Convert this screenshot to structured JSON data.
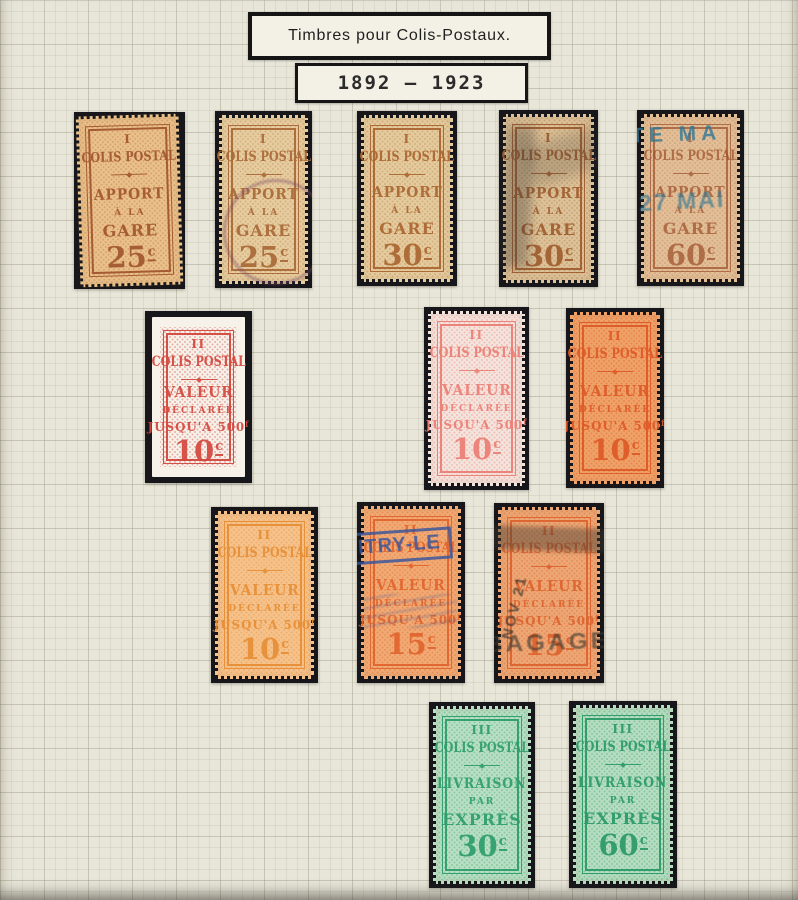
{
  "header": {
    "title": "Timbres pour Colis-Postaux.",
    "period": "1892 – 1923"
  },
  "palette": {
    "page_background": "#e8e6d9",
    "mount": "#17171b"
  },
  "stamps": [
    {
      "label": "apport-a-la-gare-25c-mint",
      "numeral": "I",
      "title": "COLIS POSTAL",
      "line1": "APPORT",
      "line2": "À LA",
      "line3": "GARE",
      "line3_sup": "",
      "value": "25",
      "unit": "c",
      "paper": "#eac18a",
      "ink": "#a2562f",
      "pattern": "rgba(162,86,47,0.30)"
    },
    {
      "label": "apport-a-la-gare-25c-used",
      "numeral": "I",
      "title": "COLIS POSTAL",
      "line1": "APPORT",
      "line2": "À LA",
      "line3": "GARE",
      "line3_sup": "",
      "value": "25",
      "unit": "c",
      "paper": "#e6cd9f",
      "ink": "#aa6a38",
      "pattern": "rgba(170,106,56,0.30)",
      "cancel": {
        "type": "circular-postmark",
        "color": "#7c4a68"
      }
    },
    {
      "label": "apport-a-la-gare-30c-mint",
      "numeral": "I",
      "title": "COLIS POSTAL",
      "line1": "APPORT",
      "line2": "À LA",
      "line3": "GARE",
      "line3_sup": "",
      "value": "30",
      "unit": "c",
      "paper": "#e4cb9d",
      "ink": "#ab6732",
      "pattern": "rgba(171,103,50,0.30)"
    },
    {
      "label": "apport-a-la-gare-30c-used",
      "numeral": "I",
      "title": "COLIS POSTAL",
      "line1": "APPORT",
      "line2": "À LA",
      "line3": "GARE",
      "line3_sup": "",
      "value": "30",
      "unit": "c",
      "paper": "#dcc298",
      "ink": "#a05e30",
      "pattern": "rgba(160,94,48,0.30)",
      "cancel": {
        "type": "smudge-postmark",
        "color": "#3f3933"
      }
    },
    {
      "label": "apport-a-la-gare-60c-used",
      "numeral": "I",
      "title": "COLIS POSTAL",
      "line1": "APPORT",
      "line2": "À LA",
      "line3": "GARE",
      "line3_sup": "",
      "value": "60",
      "unit": "c",
      "paper": "#e2bf97",
      "ink": "#9d512c",
      "pattern": "rgba(157,81,44,0.30)",
      "cancel": {
        "type": "blue-overprint",
        "color": "#2f7795",
        "line1": "TE MA",
        "line2": "27 MAI"
      }
    },
    {
      "label": "valeur-declaree-10c-red-imperf",
      "numeral": "II",
      "title": "COLIS POSTAL",
      "line1": "VALEUR",
      "line2": "DÉCLARÉE",
      "line3": "JUSQU'A 500",
      "line3_sup": "f",
      "value": "10",
      "unit": "c",
      "paper": "#f6f2ea",
      "ink": "#d4493f",
      "pattern": "rgba(212,73,63,0.42)"
    },
    {
      "label": "valeur-declaree-10c-rose",
      "numeral": "II",
      "title": "COLIS POSTAL",
      "line1": "VALEUR",
      "line2": "DÉCLARÉE",
      "line3": "JUSQU'A 500",
      "line3_sup": "f",
      "value": "10",
      "unit": "c",
      "paper": "#f3e4dd",
      "ink": "#ec7f76",
      "pattern": "rgba(236,127,118,0.40)"
    },
    {
      "label": "valeur-declaree-10c-orange-red",
      "numeral": "II",
      "title": "COLIS POSTAL",
      "line1": "VALEUR",
      "line2": "DÉCLARÉE",
      "line3": "JUSQU'A 500",
      "line3_sup": "f",
      "value": "10",
      "unit": "c",
      "paper": "#efa268",
      "ink": "#dd5a28",
      "pattern": "rgba(221,90,40,0.38)"
    },
    {
      "label": "valeur-declaree-10c-orange",
      "numeral": "II",
      "title": "COLIS POSTAL",
      "line1": "VALEUR",
      "line2": "DÉCLARÉE",
      "line3": "JUSQU'A 500",
      "line3_sup": "f",
      "value": "10",
      "unit": "c",
      "paper": "#f5c28c",
      "ink": "#e78f36",
      "pattern": "rgba(231,143,54,0.38)"
    },
    {
      "label": "valeur-declaree-15c-used-blue",
      "numeral": "II",
      "title": "COLIS POSTAL",
      "line1": "VALEUR",
      "line2": "DÉCLARÉE",
      "line3": "JUSQU'A 500",
      "line3_sup": "f",
      "value": "15",
      "unit": "c",
      "paper": "#f1aa74",
      "ink": "#e1662e",
      "pattern": "rgba(225,102,46,0.38)",
      "cancel": {
        "type": "boxed-postmark",
        "color": "#33539e",
        "text": "ITRY-LE"
      }
    },
    {
      "label": "valeur-declaree-15c-used-black",
      "numeral": "II",
      "title": "COLIS POSTAL",
      "line1": "VALEUR",
      "line2": "DÉCLARÉE",
      "line3": "JUSQU'A 500",
      "line3_sup": "f",
      "value": "15",
      "unit": "c",
      "paper": "#eca775",
      "ink": "#dd642f",
      "pattern": "rgba(221,100,47,0.38)",
      "cancel": {
        "type": "heavy-postmark",
        "color": "#39362f",
        "line1": "NOV 21",
        "line2": "BAGAGE"
      }
    },
    {
      "label": "livraison-par-expres-30c",
      "numeral": "III",
      "title": "COLIS POSTAL",
      "line1": "LIVRAISON",
      "line2": "PAR",
      "line3": "EXPRÈS",
      "line3_sup": "",
      "value": "30",
      "unit": "c",
      "paper": "#b9dfc3",
      "ink": "#2f9e6c",
      "pattern": "rgba(47,158,108,0.35)"
    },
    {
      "label": "livraison-par-expres-60c",
      "numeral": "III",
      "title": "COLIS POSTAL",
      "line1": "LIVRAISON",
      "line2": "PAR",
      "line3": "EXPRÈS",
      "line3_sup": "",
      "value": "60",
      "unit": "c",
      "paper": "#b6ddc0",
      "ink": "#2c9a68",
      "pattern": "rgba(44,154,104,0.35)"
    }
  ]
}
